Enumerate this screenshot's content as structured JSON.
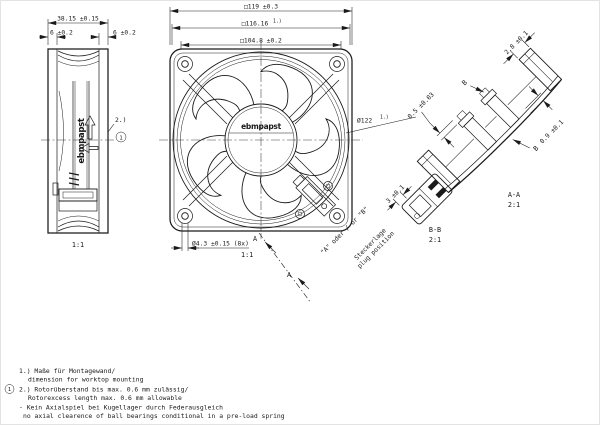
{
  "colors": {
    "ink": "#1a1a1a",
    "background": "#ffffff"
  },
  "side_view": {
    "scale": "1:1",
    "logo": "ebmpapst",
    "note_ref": "2.)",
    "note_marker": "1",
    "dim_depth": "38.15 ±0.15",
    "dim_flange_left": "6 ±0.2",
    "dim_flange_right": "6 ±0.2"
  },
  "front_view": {
    "scale": "1:1",
    "logo": "ebmpapst",
    "dim_outer": "□119 ±0.3",
    "dim_mounting": "□116.16",
    "dim_mounting_sup": "1.)",
    "dim_inner_square": "□104.8 ±0.2",
    "dim_venturi": "Ø122",
    "dim_venturi_sup": "1.)",
    "dim_holes": "Ø4.3 ±0.15 (8x)",
    "section_arrow_1": "A",
    "section_arrow_2": "A",
    "plug_options": "\"A\"  oder / or  \"B\"",
    "plug_label_de": "Steckerlage",
    "plug_label_en": "plug position"
  },
  "section_aa": {
    "title": "A-A",
    "scale": "2:1",
    "dim_flange": "2.8 ±0.1",
    "dim_lip": "0.5 ±0.03",
    "dim_wall": "0.9 ±0.1",
    "detail_ref_1": "B",
    "detail_ref_2": "B"
  },
  "detail_bb": {
    "title": "B-B",
    "scale": "2:1",
    "dim_width": "3 ±0.1"
  },
  "notes": {
    "marker": "1",
    "lines": [
      "1.) Maße für Montagewand/",
      "dimension for worktop mounting",
      "2.) Rotorüberstand bis max. 0.6 mm zulässig/",
      "Rotorexcess length max. 0.6 mm allowable",
      "- Kein Axialspiel bei Kugellager durch Federausgleich",
      "no axial clearence of ball bearings conditional in a pre-load spring"
    ]
  }
}
